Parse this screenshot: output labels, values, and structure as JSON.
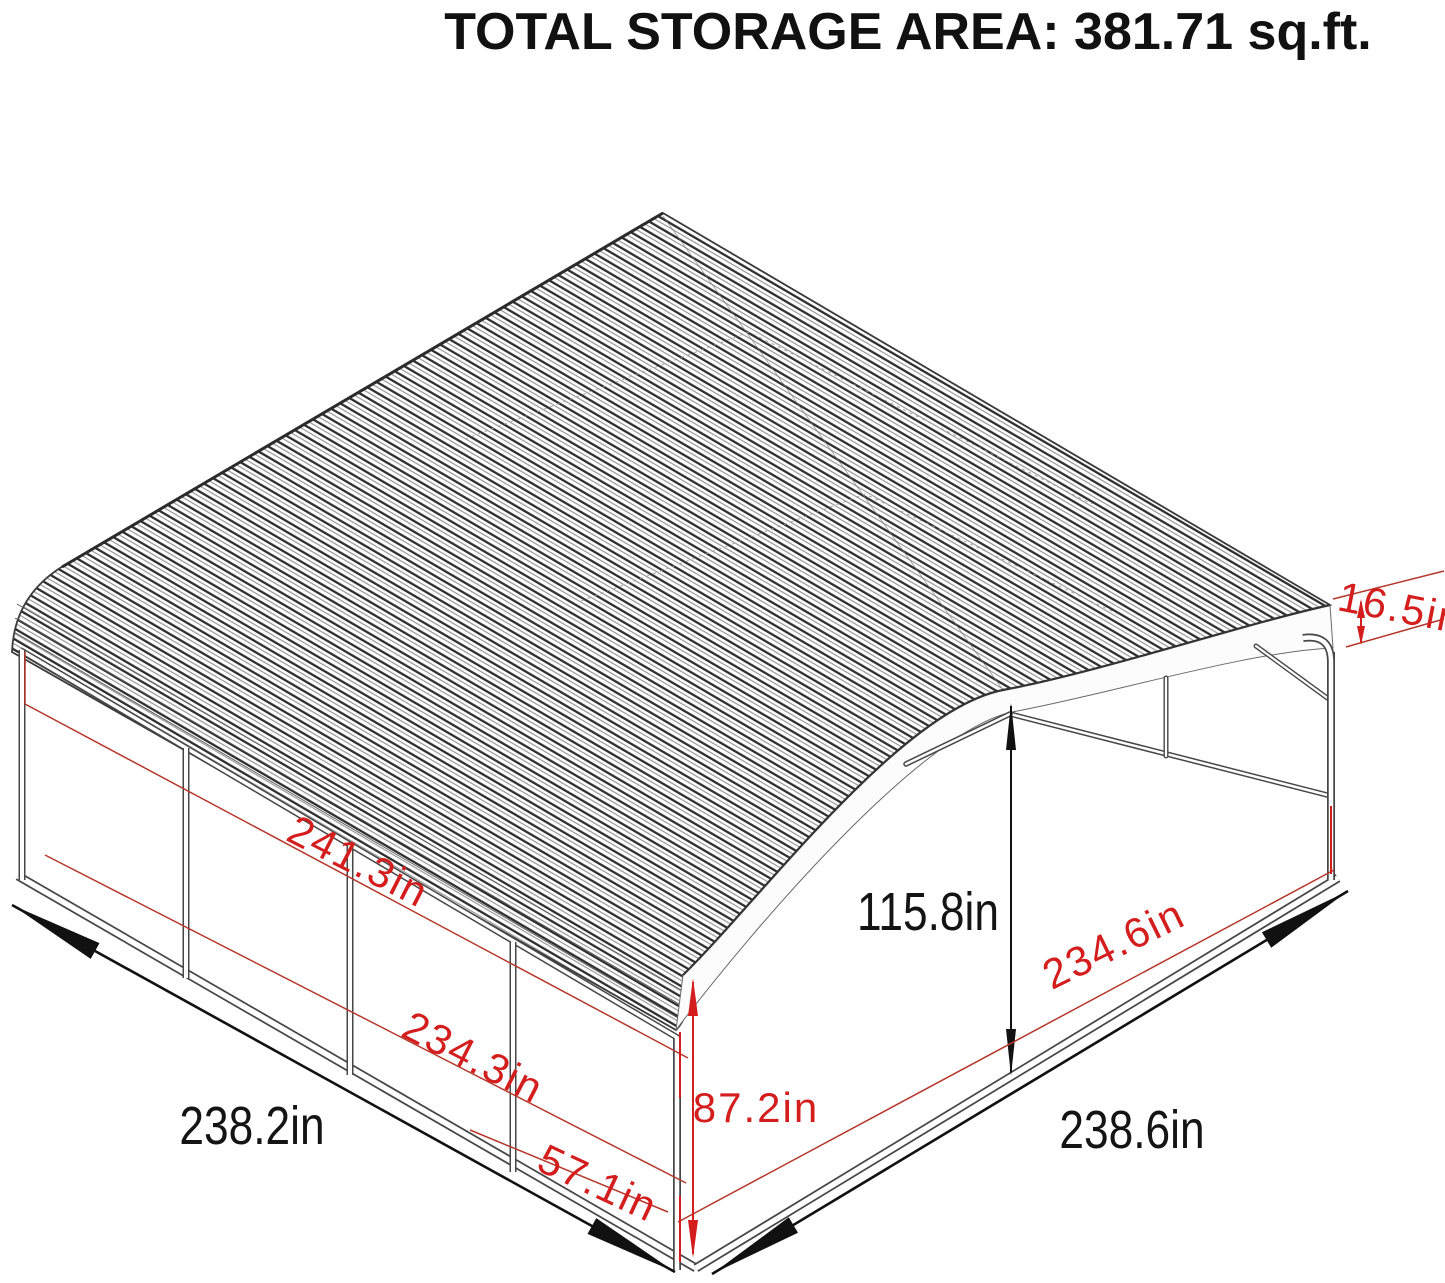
{
  "title": "TOTAL STORAGE AREA: 381.71 sq.ft.",
  "diagram": {
    "type": "isometric-carport-dimension-drawing",
    "units": "in",
    "total_storage_area_sqft": "381.71",
    "colors": {
      "dimension_red": "#d41e1e",
      "structure_line": "#474747",
      "dimension_black": "#141414"
    },
    "dimensions": [
      {
        "id": "roof-side-length",
        "label": "241.3in",
        "value": 241.3,
        "color": "red",
        "where": "left roof side length"
      },
      {
        "id": "wall-frame-length",
        "label": "234.3in",
        "value": 234.3,
        "color": "red",
        "where": "left wall frame length"
      },
      {
        "id": "bay-spacing",
        "label": "57.1in",
        "value": 57.1,
        "color": "red",
        "where": "post bay spacing"
      },
      {
        "id": "eave-height",
        "label": "87.2in",
        "value": 87.2,
        "color": "red",
        "where": "side post height"
      },
      {
        "id": "center-height",
        "label": "115.8in",
        "value": 115.8,
        "color": "black",
        "where": "center clearance height"
      },
      {
        "id": "frame-width",
        "label": "234.6in",
        "value": 234.6,
        "color": "red",
        "where": "front frame width"
      },
      {
        "id": "base-width",
        "label": "238.6in",
        "value": 238.6,
        "color": "black",
        "where": "overall width"
      },
      {
        "id": "base-length",
        "label": "238.2in",
        "value": 238.2,
        "color": "black",
        "where": "overall length"
      },
      {
        "id": "roof-edge-depth",
        "label": "16.5in",
        "value": 16.5,
        "color": "red",
        "where": "roof edge depth"
      }
    ]
  }
}
